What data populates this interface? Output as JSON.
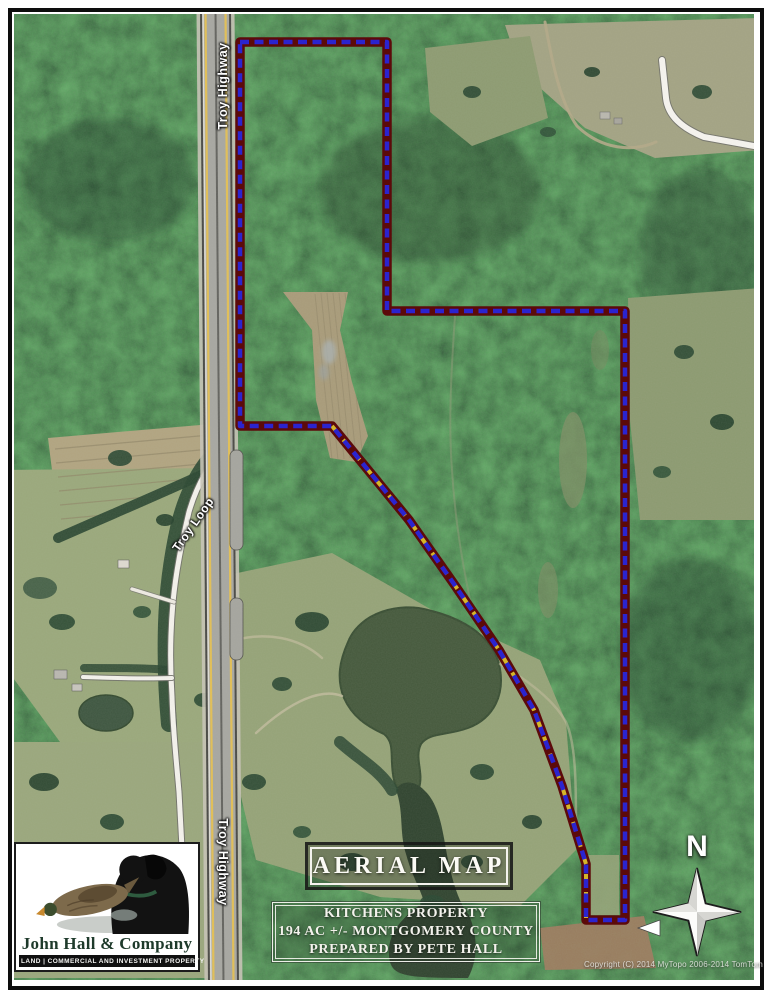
{
  "map_overlay": {
    "title_box": {
      "label": "AERIAL MAP"
    },
    "info_box": {
      "lines": [
        "KITCHENS PROPERTY",
        "194 AC +/- MONTGOMERY COUNTY",
        "PREPARED BY PETE HALL"
      ]
    },
    "logo": {
      "company": "John Hall & Company",
      "tagline": "LAND | COMMERCIAL AND INVESTMENT PROPERTY"
    },
    "compass": {
      "north_label": "N"
    },
    "road_labels": {
      "highway_top": "Troy Highway",
      "highway_bottom": "Troy Highway",
      "loop": "Troy Loop"
    },
    "copyright": "Copyright (C) 2014 MyTopo 2006-2014 TomTom"
  },
  "boundary": {
    "points": "240,42 387,42 387,311 625,311 625,920 586,920 586,864 562,786 534,710 499,650 454,584 409,520 332,426 240,426",
    "accent_points": "586,918 586,864 562,786 534,710 499,650 454,584 409,520 332,426",
    "color_outer": "#5c0a0a",
    "color_inner": "#2b24cf",
    "color_accent": "#d4b62a"
  }
}
